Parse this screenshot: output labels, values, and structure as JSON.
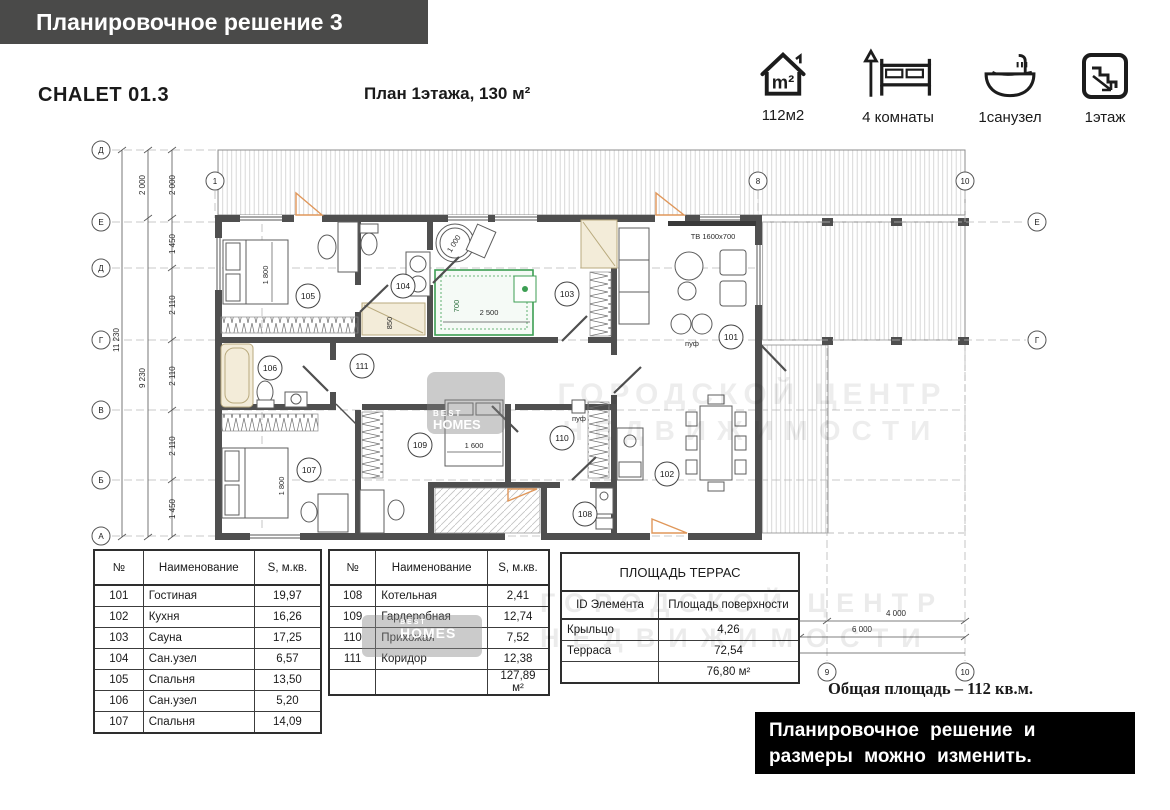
{
  "header": {
    "banner": "Планировочное решение 3",
    "model": "CHALET 01.3",
    "plan_title": "План 1этажа, 130 м²"
  },
  "features": [
    {
      "icon": "house-area-icon",
      "icon_text": "m²",
      "label": "112м2"
    },
    {
      "icon": "bed-icon",
      "label": "4 комнаты"
    },
    {
      "icon": "bath-icon",
      "label": "1санузел"
    },
    {
      "icon": "stairs-icon",
      "label": "1этаж"
    }
  ],
  "plan": {
    "axes": {
      "left": [
        "Д",
        "Е",
        "Д",
        "Г",
        "В",
        "Б",
        "А"
      ],
      "right": [
        "Е",
        "Г"
      ],
      "top": [
        "1",
        "8",
        "10"
      ],
      "bottom": [
        "9",
        "10"
      ]
    },
    "dims": {
      "left_inner": [
        "2 000",
        "1 450",
        "2 110",
        "2 110",
        "2 110",
        "1 450"
      ],
      "left_mid": [
        "2 000",
        "9 230"
      ],
      "left_outer": "11 230",
      "bottom_1": "4 000",
      "bottom_2": "6 000"
    },
    "tags": [
      "101",
      "102",
      "103",
      "104",
      "105",
      "106",
      "107",
      "108",
      "109",
      "110",
      "111"
    ],
    "labels": {
      "tv": "ТВ 1600х700",
      "puf": "пуф",
      "bed_1800": "1 800",
      "bed_1600": "1 600",
      "barrel_1000": "1 000",
      "bench_700": "700",
      "bench_2500": "2 500",
      "shower_850": "850"
    }
  },
  "watermark": {
    "line1": "ГОРОДСКОЙ ЦЕНТР",
    "line2": "НЕДВИЖИМОСТИ",
    "brand_top": "BEST",
    "brand_bottom": "HOMES"
  },
  "tables": {
    "rooms1": {
      "headers": [
        "№",
        "Наименование",
        "S, м.кв."
      ],
      "rows": [
        [
          "101",
          "Гостиная",
          "19,97"
        ],
        [
          "102",
          "Кухня",
          "16,26"
        ],
        [
          "103",
          "Сауна",
          "17,25"
        ],
        [
          "104",
          "Сан.узел",
          "6,57"
        ],
        [
          "105",
          "Спальня",
          "13,50"
        ],
        [
          "106",
          "Сан.узел",
          "5,20"
        ],
        [
          "107",
          "Спальня",
          "14,09"
        ]
      ]
    },
    "rooms2": {
      "headers": [
        "№",
        "Наименование",
        "S, м.кв."
      ],
      "rows": [
        [
          "108",
          "Котельная",
          "2,41"
        ],
        [
          "109",
          "Гардеробная",
          "12,74"
        ],
        [
          "110",
          "Прихожая",
          "7,52"
        ],
        [
          "111",
          "Коридор",
          "12,38"
        ]
      ],
      "total": "127,89 м²"
    },
    "terraces": {
      "title": "ПЛОЩАДЬ ТЕРРАС",
      "headers": [
        "ID Элемента",
        "Площадь поверхности"
      ],
      "rows": [
        [
          "Крыльцо",
          "4,26"
        ],
        [
          "Терраса",
          "72,54"
        ]
      ],
      "total": "76,80 м²"
    }
  },
  "footer": {
    "total_area": "Общая площадь – 112 кв.м.",
    "note_line1": "Планировочное решение и",
    "note_line2": "размеры можно изменить."
  }
}
